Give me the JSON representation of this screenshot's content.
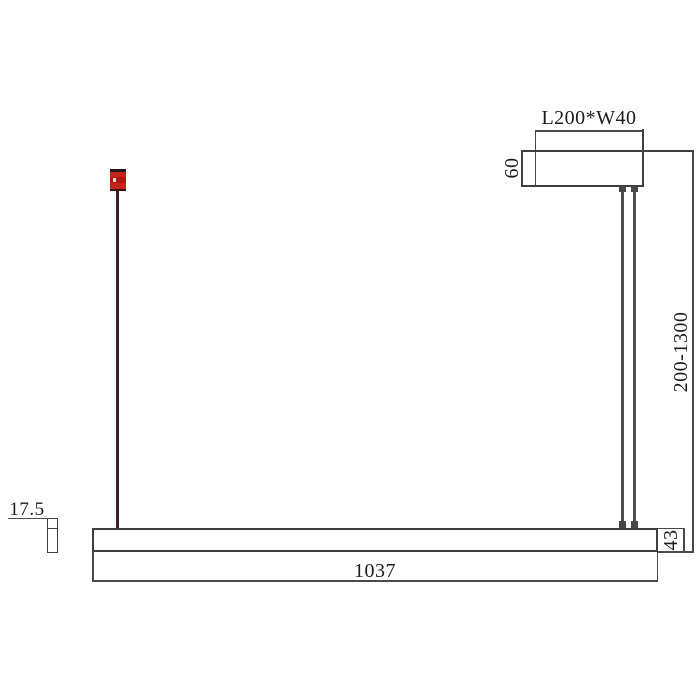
{
  "drawing_title": "linear-pendant-lamp-dimension-drawing",
  "labels": {
    "canopy_size": "L200*W40",
    "canopy_height": "60",
    "suspension_range": "200-1300",
    "bar_length": "1037",
    "bar_height": "43",
    "profile_width": "17.5"
  },
  "colors": {
    "background": "#ffffff",
    "object_line": "#3f3f3f",
    "dimension_line": "#4a4a4a",
    "text": "#1c1c1c",
    "suspension_wire": "#4f4f4f",
    "left_wire": "#3b2423",
    "red_connector": "#c3251c"
  }
}
